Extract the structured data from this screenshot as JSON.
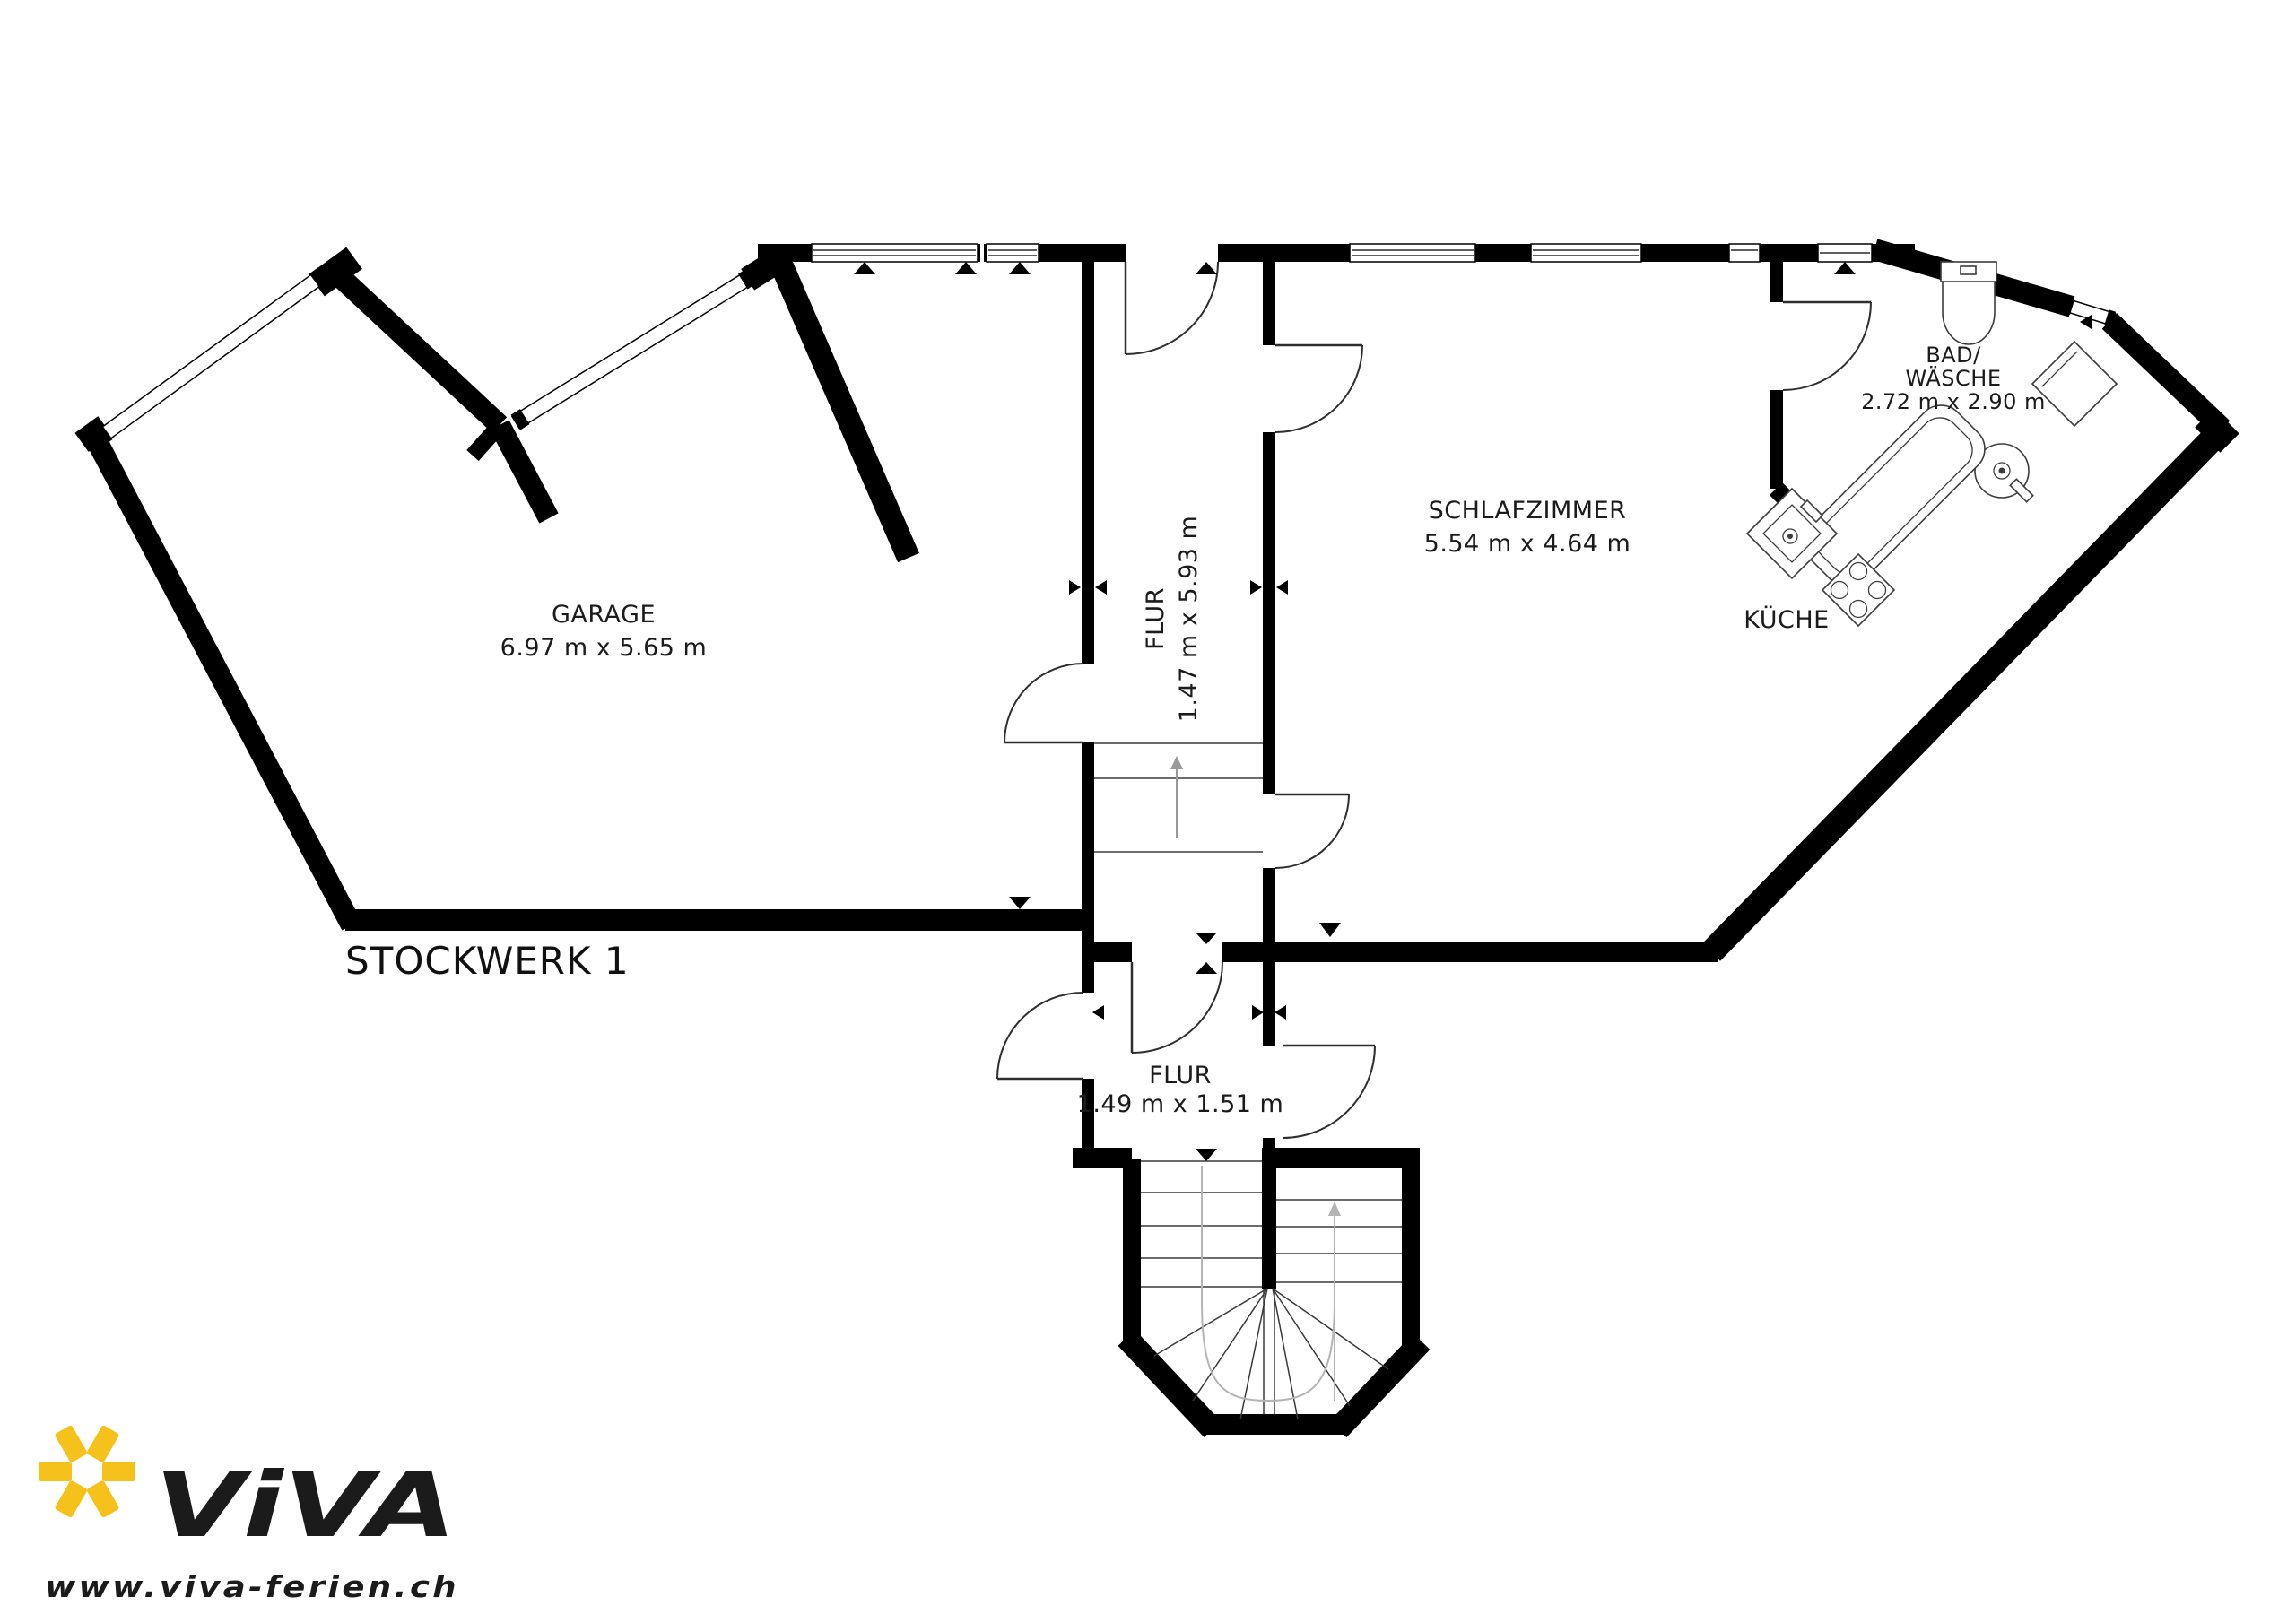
{
  "floor_label": "STOCKWERK 1",
  "rooms": {
    "garage": {
      "name": "GARAGE",
      "dims": "6.97 m x 5.65 m"
    },
    "flur_upper": {
      "name": "FLUR",
      "dims": "1.47 m x 5.93 m"
    },
    "schlafzimmer": {
      "name": "SCHLAFZIMMER",
      "dims": "5.54 m x 4.64 m"
    },
    "bad_waesche": {
      "name_line1": "BAD/",
      "name_line2": "WÄSCHE",
      "dims": "2.72 m x 2.90 m"
    },
    "kueche": {
      "name": "KÜCHE"
    },
    "flur_lower": {
      "name": "FLUR",
      "dims": "1.49 m x 1.51 m"
    }
  },
  "logo": {
    "brand": "ViVA",
    "website": "www.viva-ferien.ch"
  },
  "colors": {
    "wall": "#000000",
    "window_highlight": "#E9E9F7",
    "logo_blue": "#1C4E7D",
    "logo_yellow": "#F5C21B",
    "guide_gray": "#B4B4B4"
  },
  "icons": {
    "sun": "sun-icon",
    "toilet": "toilet-icon",
    "washing_machine": "washing-machine-icon",
    "washbasin": "washbasin-icon",
    "bathtub": "bathtub-icon",
    "kitchen_sink": "kitchen-sink-icon",
    "stove": "stove-icon",
    "stairs": "stairs-icon"
  }
}
